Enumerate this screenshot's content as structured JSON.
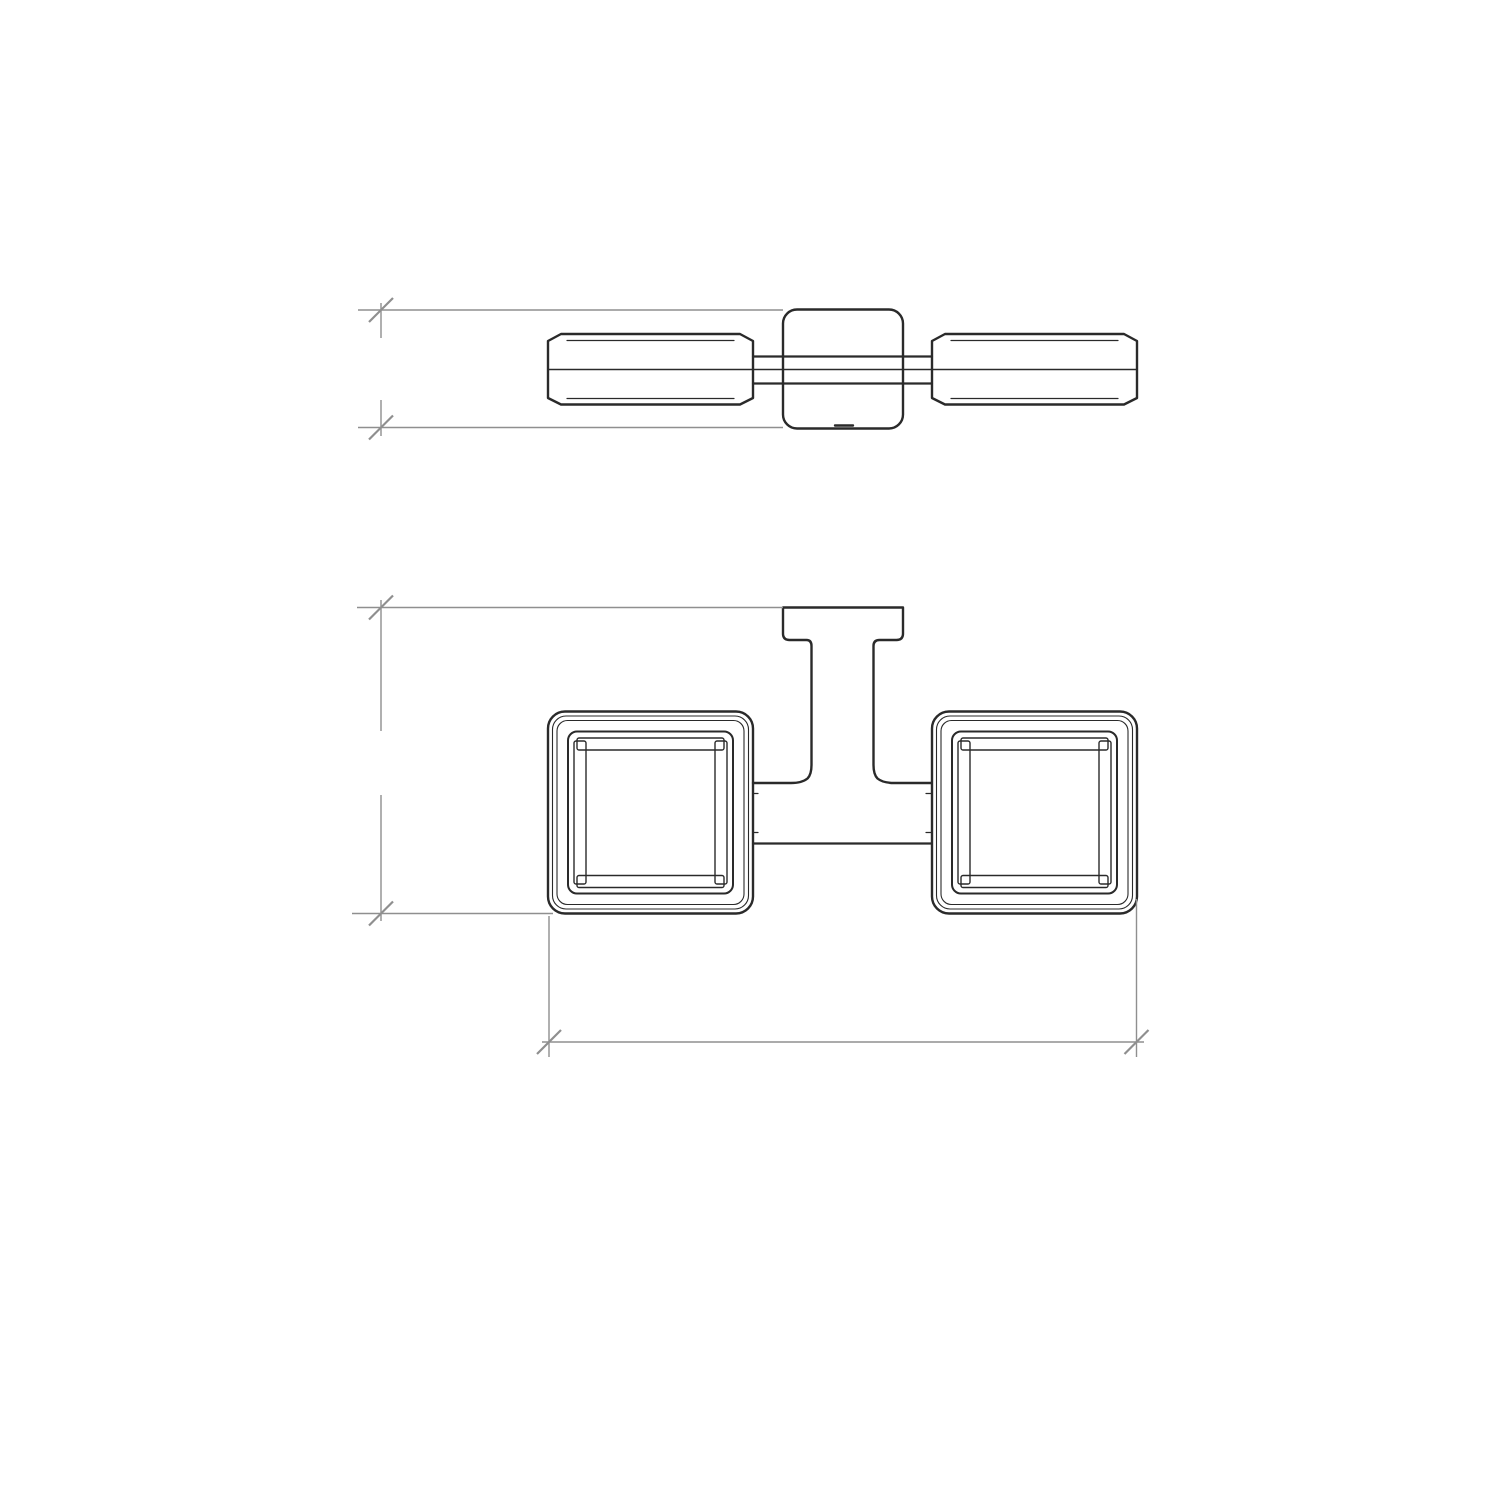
{
  "drawing": {
    "type": "technical-dimension-drawing",
    "subject": "double-holder-wall-fixture-two-views",
    "dimensions": {
      "plate_height": "40",
      "projection_depth": "105",
      "overall_width": "197"
    },
    "colors": {
      "object_line": "#2a2a2a",
      "dimension_line": "#8f8f8f",
      "text": "#141414",
      "background": "#ffffff"
    }
  }
}
